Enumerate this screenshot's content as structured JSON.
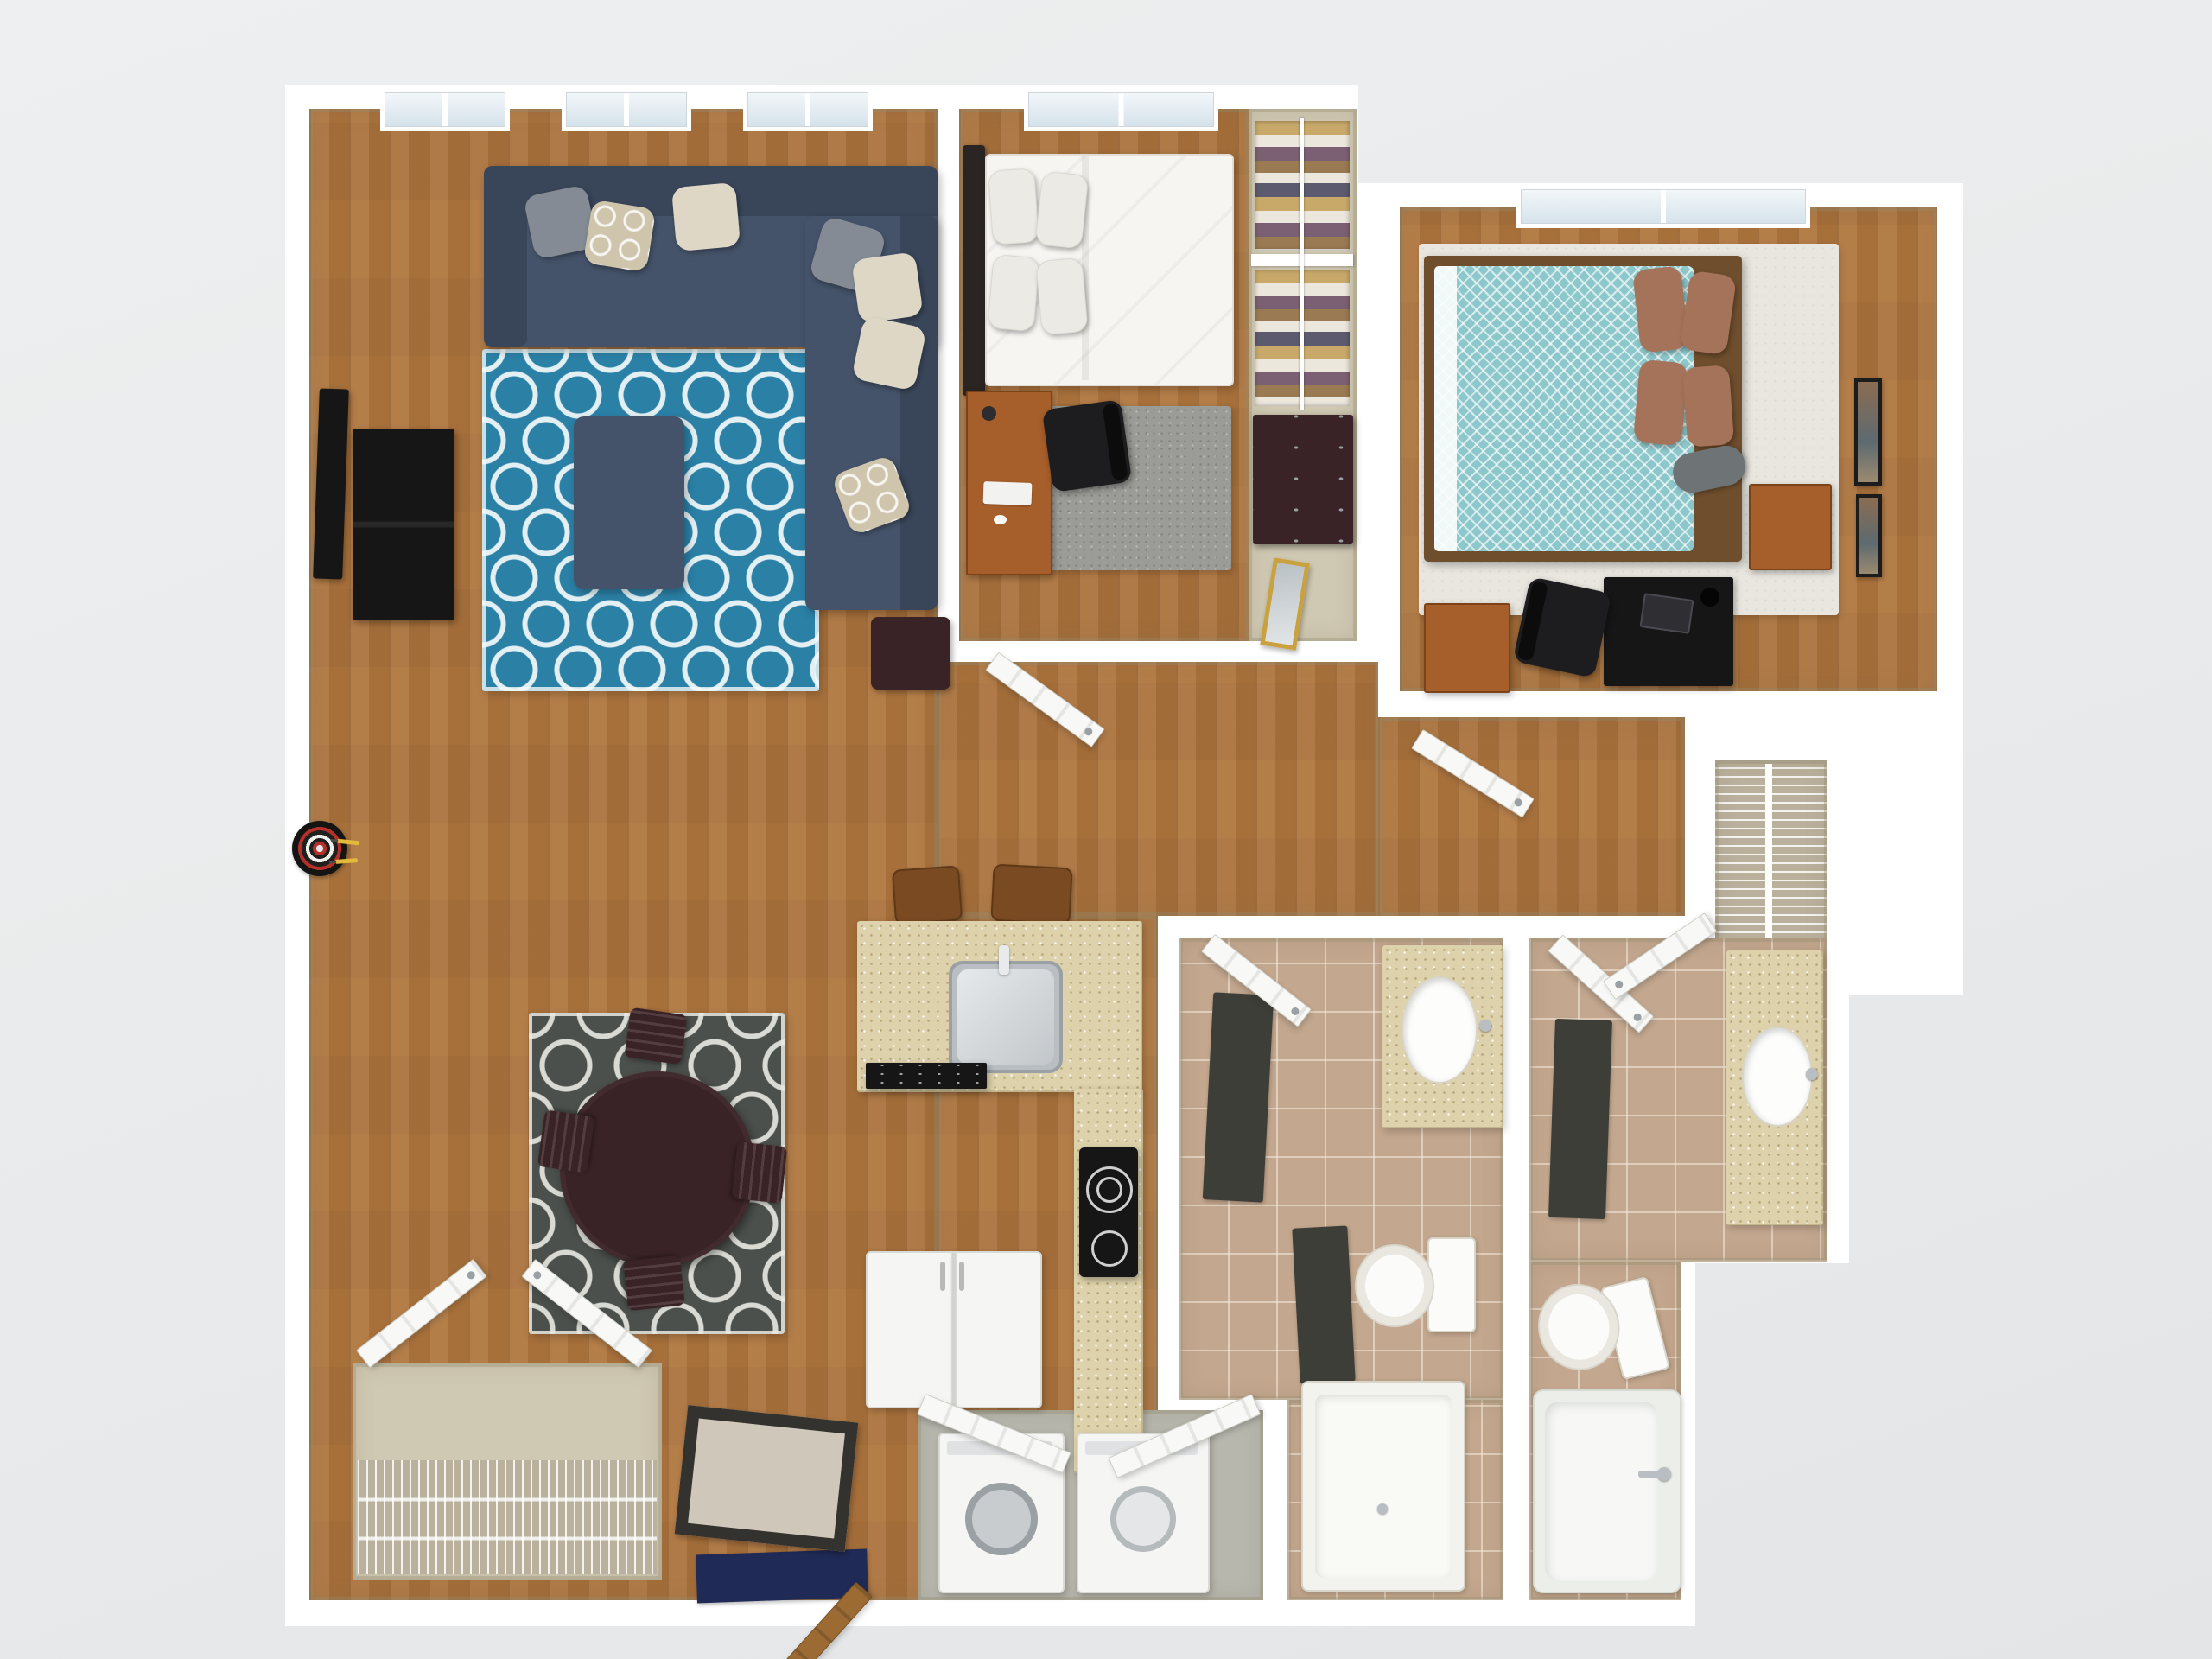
{
  "scene": {
    "description": "3D rendered top-down dollhouse floor plan of a two-bedroom, two-bathroom apartment",
    "render_style": "photoreal 3D floor plan on plain light-gray background",
    "text_visible": "none"
  },
  "palette": {
    "wall": "#ffffff",
    "wall-inner": "#d6d0bd",
    "wood": "#b0763e",
    "tile": "#c3a78e",
    "closet": "#cfc8b2",
    "laundry-floor": "#b7b7ae",
    "counter": "#ddd2ab",
    "navy-sofa": "#45536a",
    "navy-dark": "#394659",
    "rug-blue": "#2b80a6",
    "rug-gray": "#4b504c",
    "espresso": "#3a2327",
    "cherry": "#a65e2b",
    "teal-duvet": "#8cc7cb",
    "brown-pillow": "#a5735a",
    "cream-rug": "#e8e6de",
    "shag": "#9b9b97",
    "door": "#f8f8f6",
    "door-wood": "#9c6b33",
    "mat-navy": "#1f2a56",
    "mat-dark": "#3e3e39",
    "gold": "#c9a23f",
    "glass": "#dde8ef",
    "dart-yellow": "#e3b93c"
  },
  "totals": {
    "bedrooms": 2,
    "bathrooms": 2,
    "windows": 5,
    "closets": 4,
    "exterior_doors": 1
  },
  "rooms": {
    "living_room": {
      "label": "Living Room",
      "floor": "hardwood",
      "windows": 3,
      "items": [
        "L-sectional navy sofa",
        "7 throw pillows",
        "blue trellis area rug",
        "navy ottoman",
        "wall-mounted TV",
        "black media console",
        "espresso side table",
        "dartboard with darts"
      ]
    },
    "dining_area": {
      "label": "Dining Area",
      "floor": "hardwood",
      "chairs": 4,
      "items": [
        "round espresso dining table",
        "4 slat-back chairs",
        "gray trellis area rug"
      ]
    },
    "kitchen": {
      "label": "Kitchen",
      "floor": "hardwood",
      "bar_stools": 2,
      "items": [
        "island with stainless sink and faucet",
        "black dishwasher front",
        "2 wood bar stools",
        "L-shaped speckled counter",
        "black cooktop with 2 burners",
        "refrigerator"
      ]
    },
    "entry": {
      "label": "Entry",
      "items": [
        "open wood front door",
        "navy exterior mat",
        "dark-trim interior mat"
      ]
    },
    "coat_closet": {
      "label": "Coat Closet",
      "items": [
        "wire shelving",
        "double swing doors"
      ]
    },
    "laundry_closet": {
      "label": "Laundry Closet",
      "floor": "gray vinyl",
      "items": [
        "washer",
        "dryer",
        "bifold doors"
      ]
    },
    "hallway": {
      "label": "Hallway",
      "items": [
        "interior swing doors"
      ]
    },
    "bedroom_1": {
      "label": "Bedroom 1",
      "floor": "hardwood",
      "windows": 1,
      "items": [
        "bed with white duvet and dark headboard",
        "4 white pillows",
        "gray shag rug",
        "cherry desk with keyboard and mouse",
        "black office chair",
        "reach-in closet with hanging clothes",
        "espresso dresser",
        "gold leaning mirror"
      ]
    },
    "bedroom_2": {
      "label": "Bedroom 2",
      "floor": "hardwood with cream area rug",
      "windows": 1,
      "items": [
        "bed with teal patterned duvet",
        "4 brown pillows",
        "gray bolster",
        "cherry nightstand",
        "black desk with laptop",
        "black office chair",
        "cherry chest",
        "2 framed wall art"
      ]
    },
    "walk_in_closet": {
      "label": "Walk-in / Linen Closet",
      "items": [
        "wire shelving"
      ]
    },
    "bathroom_1": {
      "label": "Bathroom 1",
      "floor": "tile",
      "items": [
        "speckled vanity with oval sink",
        "toilet",
        "walk-in shower",
        "2 dark bath mats"
      ]
    },
    "bathroom_2": {
      "label": "Bathroom 2",
      "floor": "tile",
      "items": [
        "speckled vanity with oval sink",
        "toilet",
        "bathtub with chrome faucet",
        "dark bath mat"
      ]
    }
  }
}
